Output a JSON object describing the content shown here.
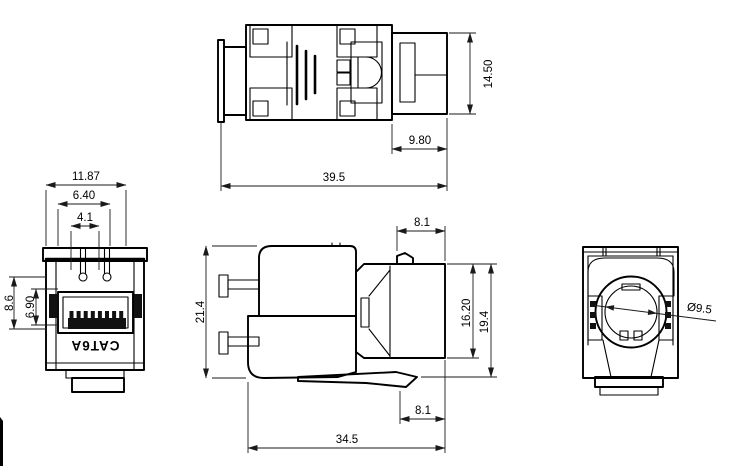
{
  "drawing": {
    "product_marking": "CAT6A",
    "views": {
      "top_view": {
        "dims": {
          "block_height": "14.50",
          "rear_depth": "9.80",
          "overall_length": "39.5"
        }
      },
      "front_view": {
        "dims": {
          "face_width": "11.87",
          "opening_width": "6.40",
          "notch_spacing": "4.1",
          "outer_height": "8.6",
          "opening_height": "6.90"
        }
      },
      "side_view": {
        "dims": {
          "nose_depth_top": "8.1",
          "overall_height": "21.4",
          "face_height": "16.20",
          "flange_height": "19.4",
          "nose_depth_bottom": "8.1",
          "overall_depth": "34.5"
        }
      },
      "rear_view": {
        "dims": {
          "entry_diameter": "Ø9.5"
        }
      }
    }
  }
}
